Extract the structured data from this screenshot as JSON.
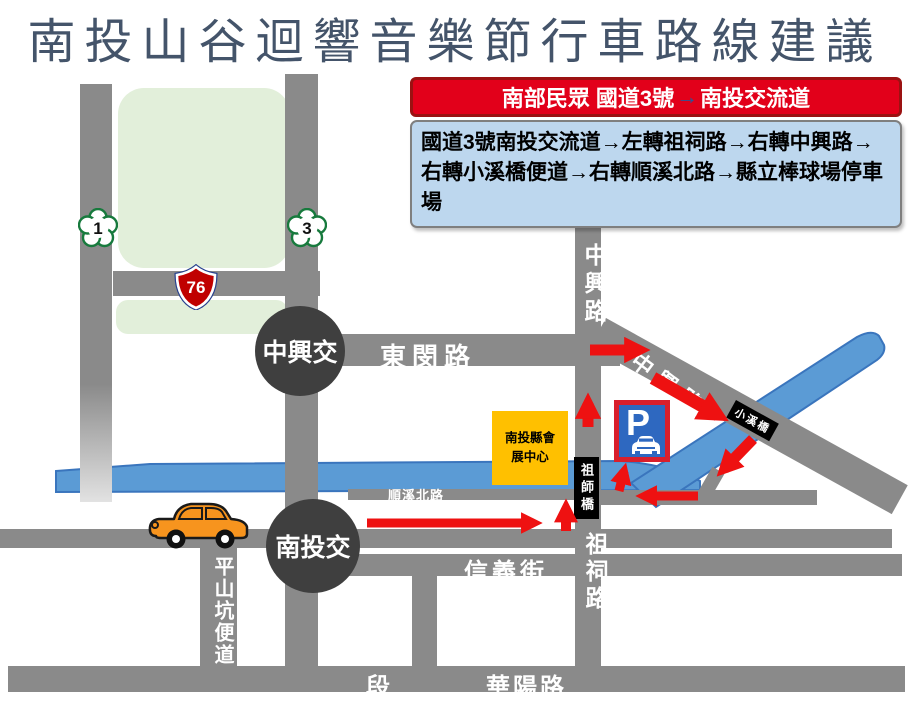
{
  "title": "南投山谷迴響音樂節行車路線建議",
  "banner": {
    "prefix": "南部民眾 國道3號",
    "arrow": "→",
    "suffix": "南投交流道"
  },
  "route_box": {
    "line1": "國道3號南投交流道→左轉祖祠路→右轉中興路→",
    "line2": "右轉小溪橋便道→右轉順溪北路→縣立棒球場停車",
    "line3": "場"
  },
  "shields": {
    "national_1": "1",
    "national_3": "3",
    "expressway_76": "76"
  },
  "junctions": {
    "zhongxing": "中興交",
    "nantou": "南投交"
  },
  "roads": {
    "dongmin": "東閔路",
    "zhongxing_north": "中興路",
    "zhongxing_diagonal": "中興路",
    "shunxi_north": "順溪北路",
    "zuci": "祖祠路",
    "xinyi": "信義街",
    "pingshankeng": "平山坑便道",
    "huayang": "華陽路",
    "duan": "段"
  },
  "bridges": {
    "xiaoxi": "小溪橋",
    "zushi": "祖師橋"
  },
  "venue": {
    "line1": "南投縣會",
    "line2": "展中心"
  },
  "parking_sign": {
    "letter": "P"
  },
  "colors": {
    "title_navy": "#44546a",
    "banner_red": "#e2001a",
    "route_box_blue": "#bdd7ee",
    "road_gray": "#8a8a8a",
    "river_blue": "#5b9bd5",
    "arrow_red": "#ee1111",
    "junction_gray": "#3f3f3f",
    "park_green": "#e2efda",
    "venue_yellow": "#ffc000",
    "parking_blue": "#2e68c0",
    "expressway_red": "#c00000",
    "shield_green": "#177a3d"
  }
}
